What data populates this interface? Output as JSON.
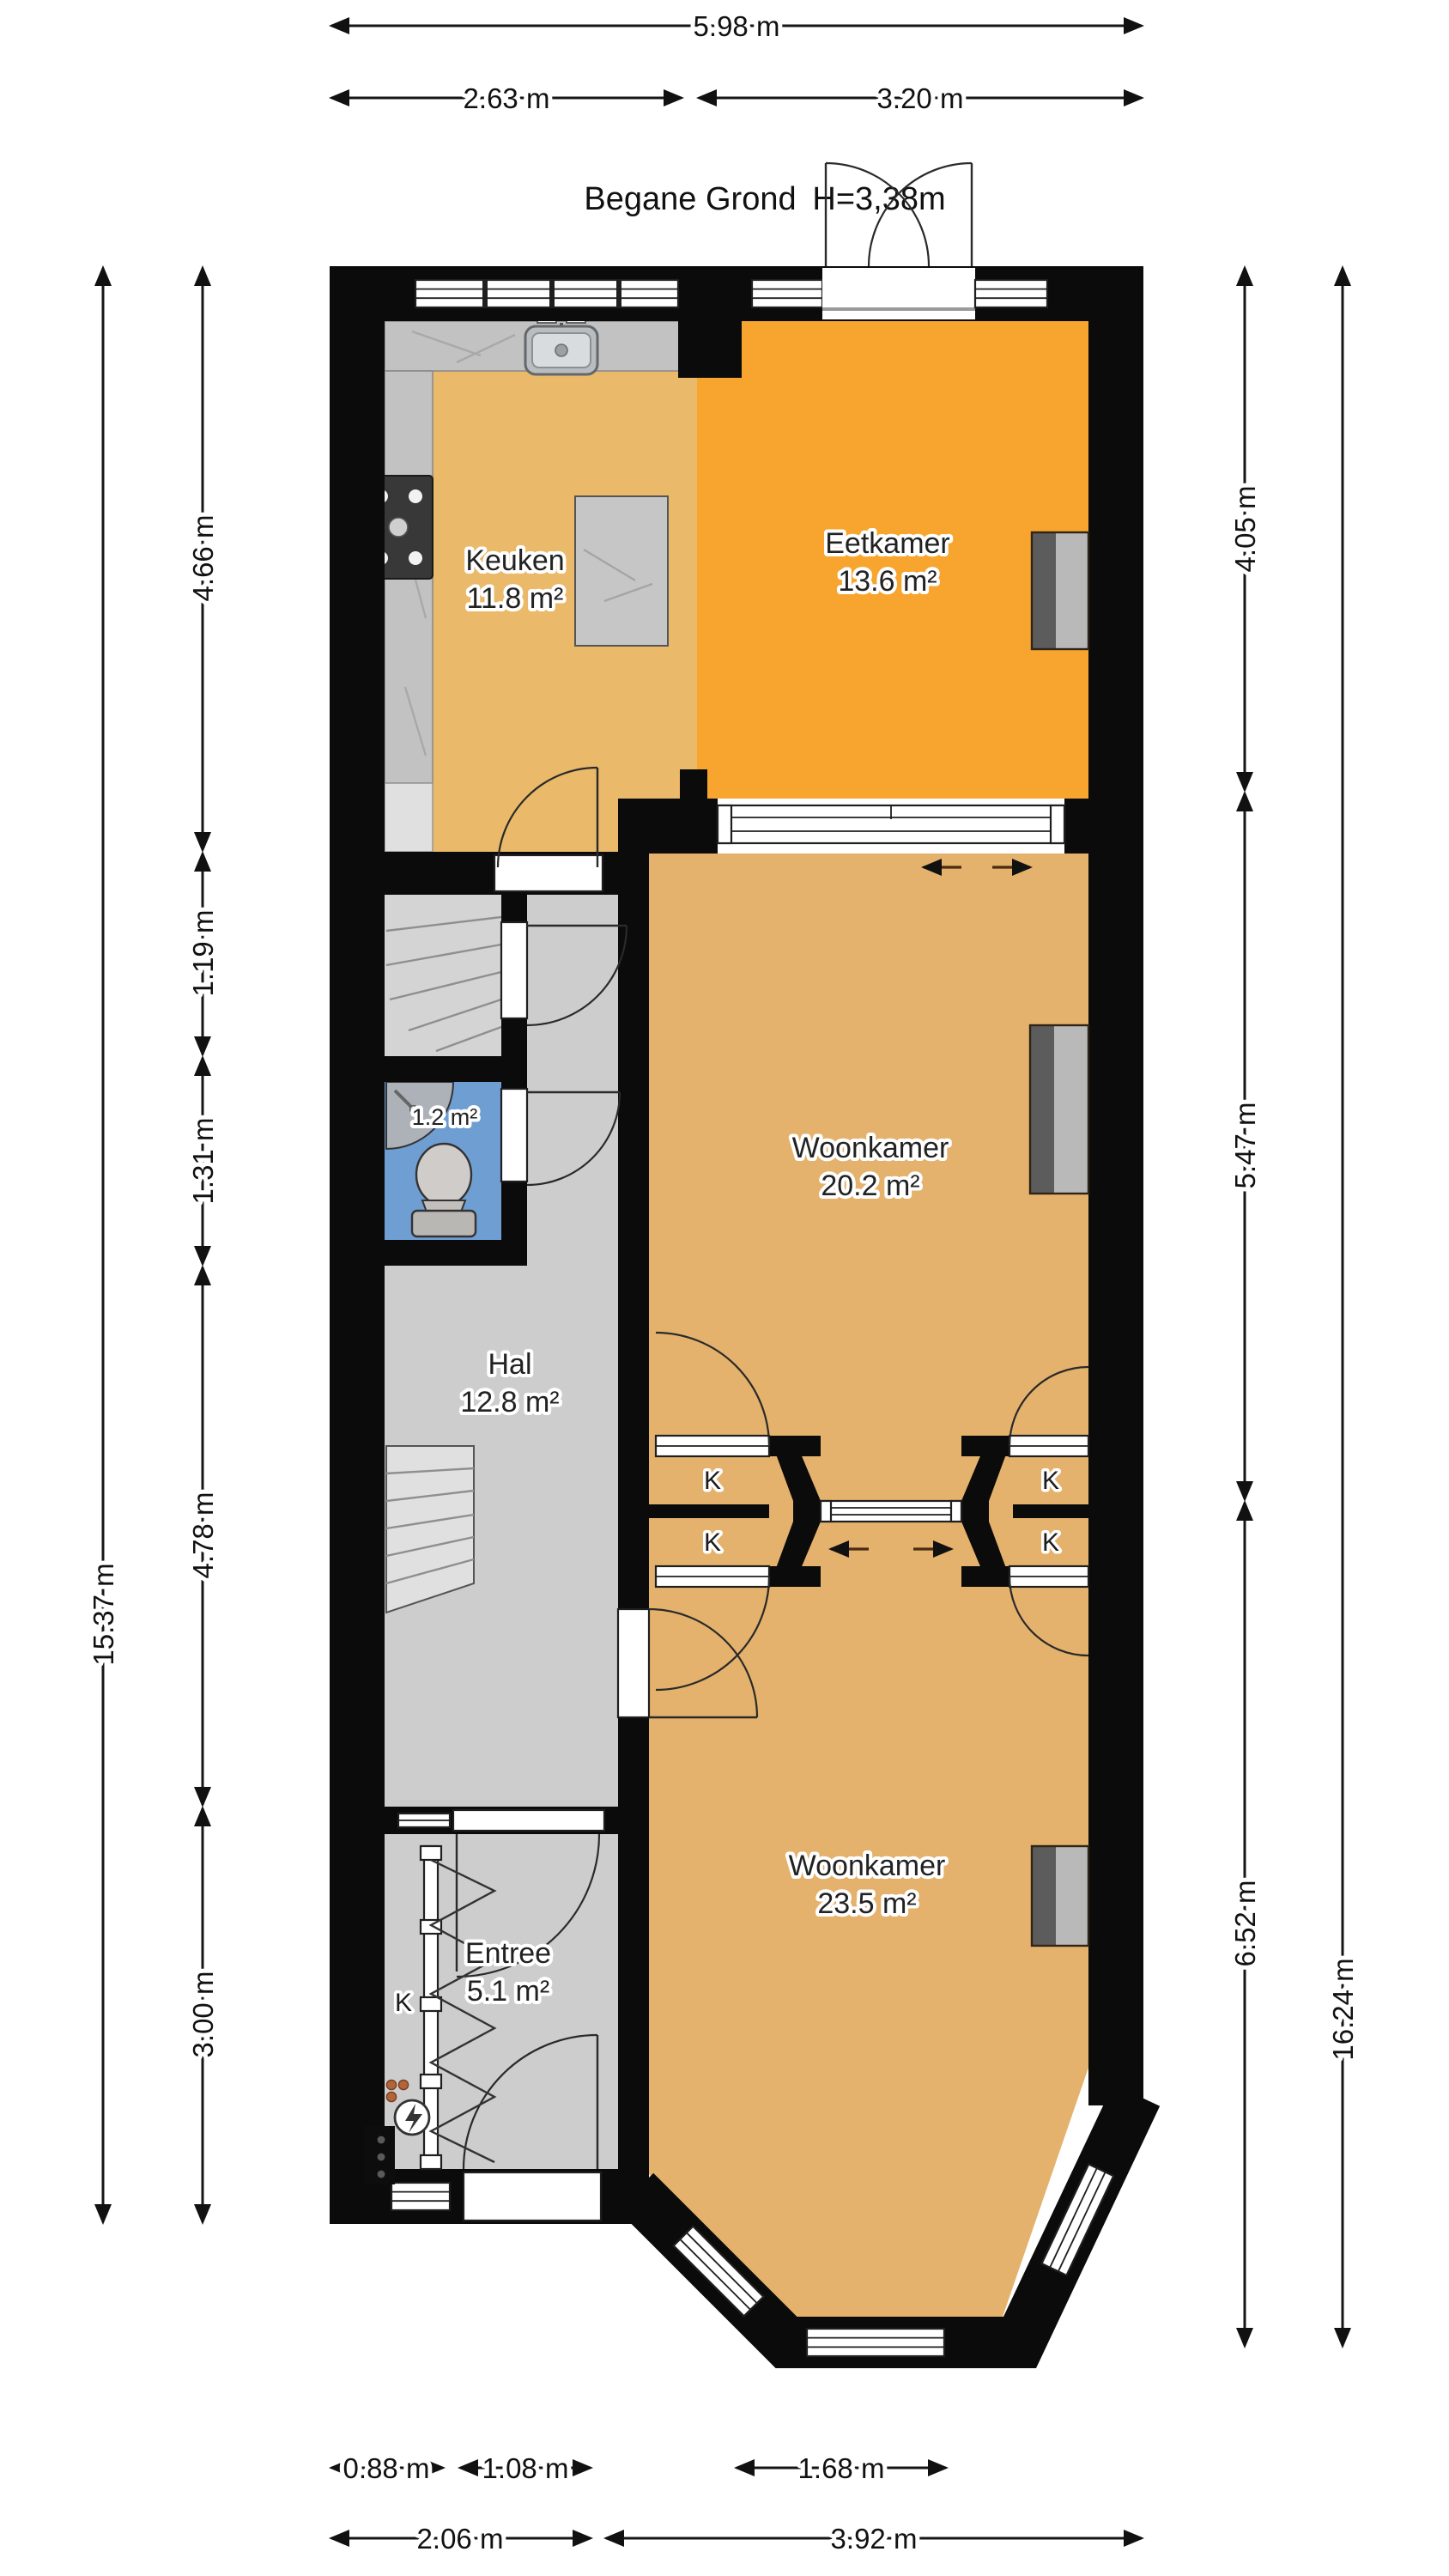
{
  "title": {
    "floor_label": "Begane Grond",
    "ceiling_height": "H=3,38m"
  },
  "rooms": {
    "keuken": {
      "name": "Keuken",
      "area": "11.8 m²"
    },
    "eetkamer": {
      "name": "Eetkamer",
      "area": "13.6 m²"
    },
    "woonkamer_achter": {
      "name": "Woonkamer",
      "area": "20.2 m²"
    },
    "hal": {
      "name": "Hal",
      "area": "12.8 m²"
    },
    "toilet": {
      "area": "1.2 m²"
    },
    "entree": {
      "name": "Entree",
      "area": "5.1 m²"
    },
    "woonkamer_voor": {
      "name": "Woonkamer",
      "area": "23.5 m²"
    }
  },
  "closets": {
    "label": "K"
  },
  "dimensions": {
    "top": {
      "total": "5.98 m",
      "segments": [
        "2.63 m",
        "3.20 m"
      ]
    },
    "left": {
      "total": "15.37 m",
      "segments": [
        "4.66 m",
        "1.19 m",
        "1.31 m",
        "4.78 m",
        "3.00 m"
      ]
    },
    "right": {
      "total": "16.24 m",
      "segments": [
        "4.05 m",
        "5.47 m",
        "6.52 m"
      ]
    },
    "bottom": {
      "row1": [
        "0.88 m",
        "1.08 m",
        "1.68 m"
      ],
      "row2": [
        "2.06 m",
        "3.92 m"
      ]
    }
  },
  "icons": {
    "electric_meter": "lightning-bolt",
    "sink": "kitchen-sink",
    "stove": "four-burner-cooktop",
    "toilet": "toilet-top-view",
    "corner_sink": "corner-washbasin"
  },
  "colors": {
    "wall": "#0b0b0b",
    "keuken_floor": "#eab96a",
    "eetkamer_floor": "#f7a52f",
    "woonkamer_floor": "#e4b26c",
    "hal_floor": "#cdcdcd",
    "toilet_floor": "#6f9ed3",
    "counter": "#c2c2c2",
    "radiator_dark": "#5c5c5c",
    "radiator_light": "#b9b9b9"
  }
}
